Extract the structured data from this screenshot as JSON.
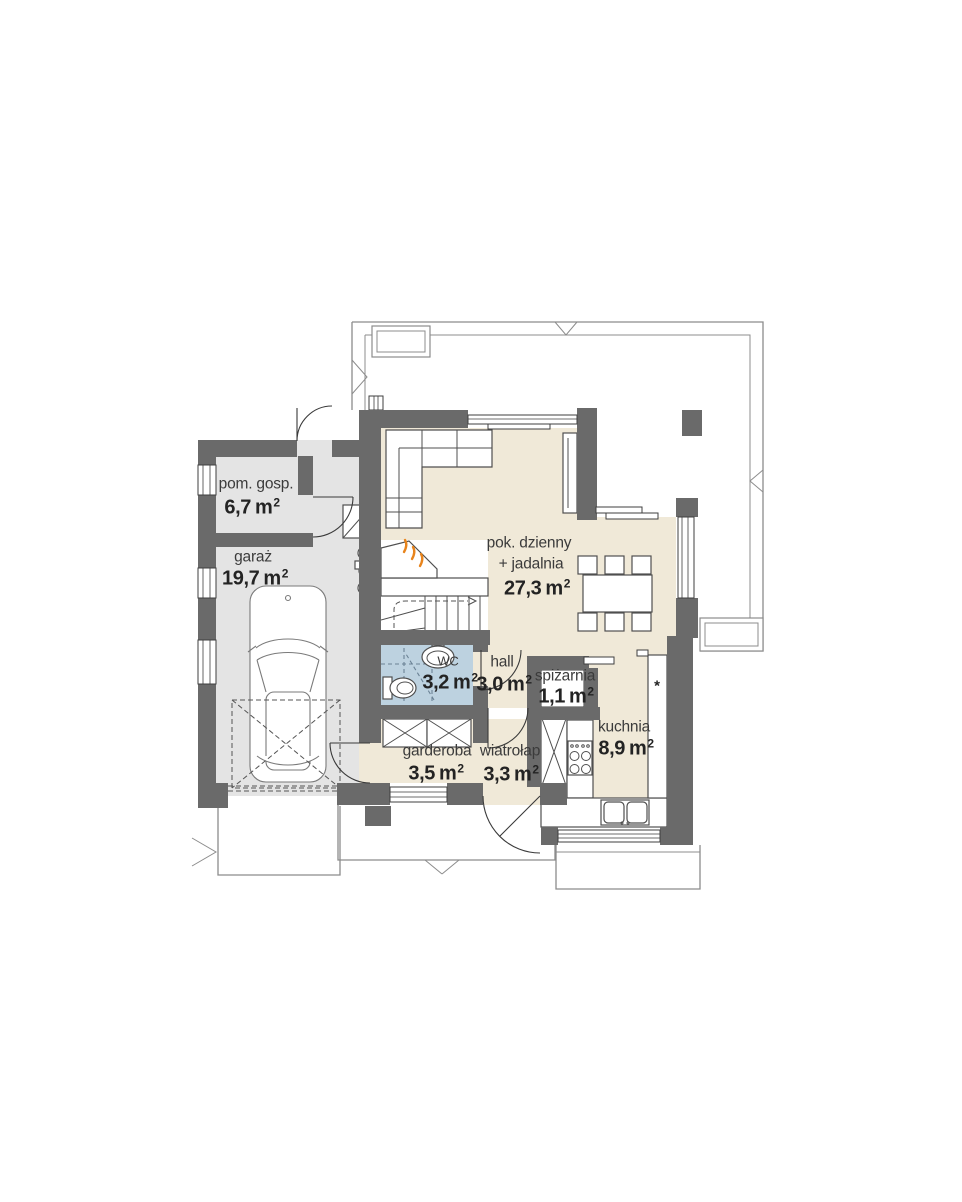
{
  "colors": {
    "wall": "#6a6a6a",
    "floor_main": "#f0e9d8",
    "floor_garage": "#e4e4e4",
    "floor_wc": "#bdd2e0",
    "outline": "#8c8c8c",
    "accent_flame": "#e8841c",
    "dash_blue": "#6b8295"
  },
  "rooms": [
    {
      "id": "pom-gosp",
      "name": "pom. gosp.",
      "area": "6,7",
      "unit": "m",
      "sup": "2"
    },
    {
      "id": "garaz",
      "name": "garaż",
      "area": "19,7",
      "unit": "m",
      "sup": "2"
    },
    {
      "id": "pok-dzienny",
      "name": "pok. dzienny",
      "subname": "+ jadalnia",
      "area": "27,3",
      "unit": "m",
      "sup": "2"
    },
    {
      "id": "wc",
      "name": "WC",
      "area": "3,2",
      "unit": "m",
      "sup": "2"
    },
    {
      "id": "hall",
      "name": "hall",
      "area": "3,0",
      "unit": "m",
      "sup": "2"
    },
    {
      "id": "spizarnia",
      "name": "spiżarnia",
      "area": "1,1",
      "unit": "m",
      "sup": "2"
    },
    {
      "id": "kuchnia",
      "name": "kuchnia",
      "area": "8,9",
      "unit": "m",
      "sup": "2"
    },
    {
      "id": "garderoba",
      "name": "garderoba",
      "area": "3,5",
      "unit": "m",
      "sup": "2"
    },
    {
      "id": "wiatrolap",
      "name": "wiatrołap",
      "area": "3,3",
      "unit": "m",
      "sup": "2"
    }
  ],
  "symbols": {
    "freezer": "*"
  }
}
